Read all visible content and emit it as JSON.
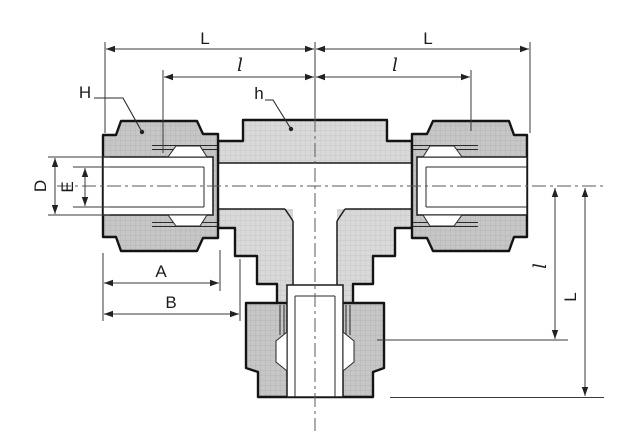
{
  "drawing": {
    "labels": {
      "L_top_left": "L",
      "l_top_left": "l",
      "L_top_right": "L",
      "l_top_right": "l",
      "H_callout": "H",
      "h_callout": "h",
      "D_dim": "D",
      "E_dim": "E",
      "A_dim": "A",
      "B_dim": "B",
      "l_right_vertical": "l",
      "L_right_vertical": "L"
    },
    "colors": {
      "outline": "#141414",
      "body_fill": "#d9d9d9",
      "nut_fill": "#c6c6c6",
      "hatch_line": "#b4b4b4",
      "dimension_line": "#3a3a3a",
      "label_text": "#1b1b1b",
      "background": "#ffffff"
    }
  }
}
